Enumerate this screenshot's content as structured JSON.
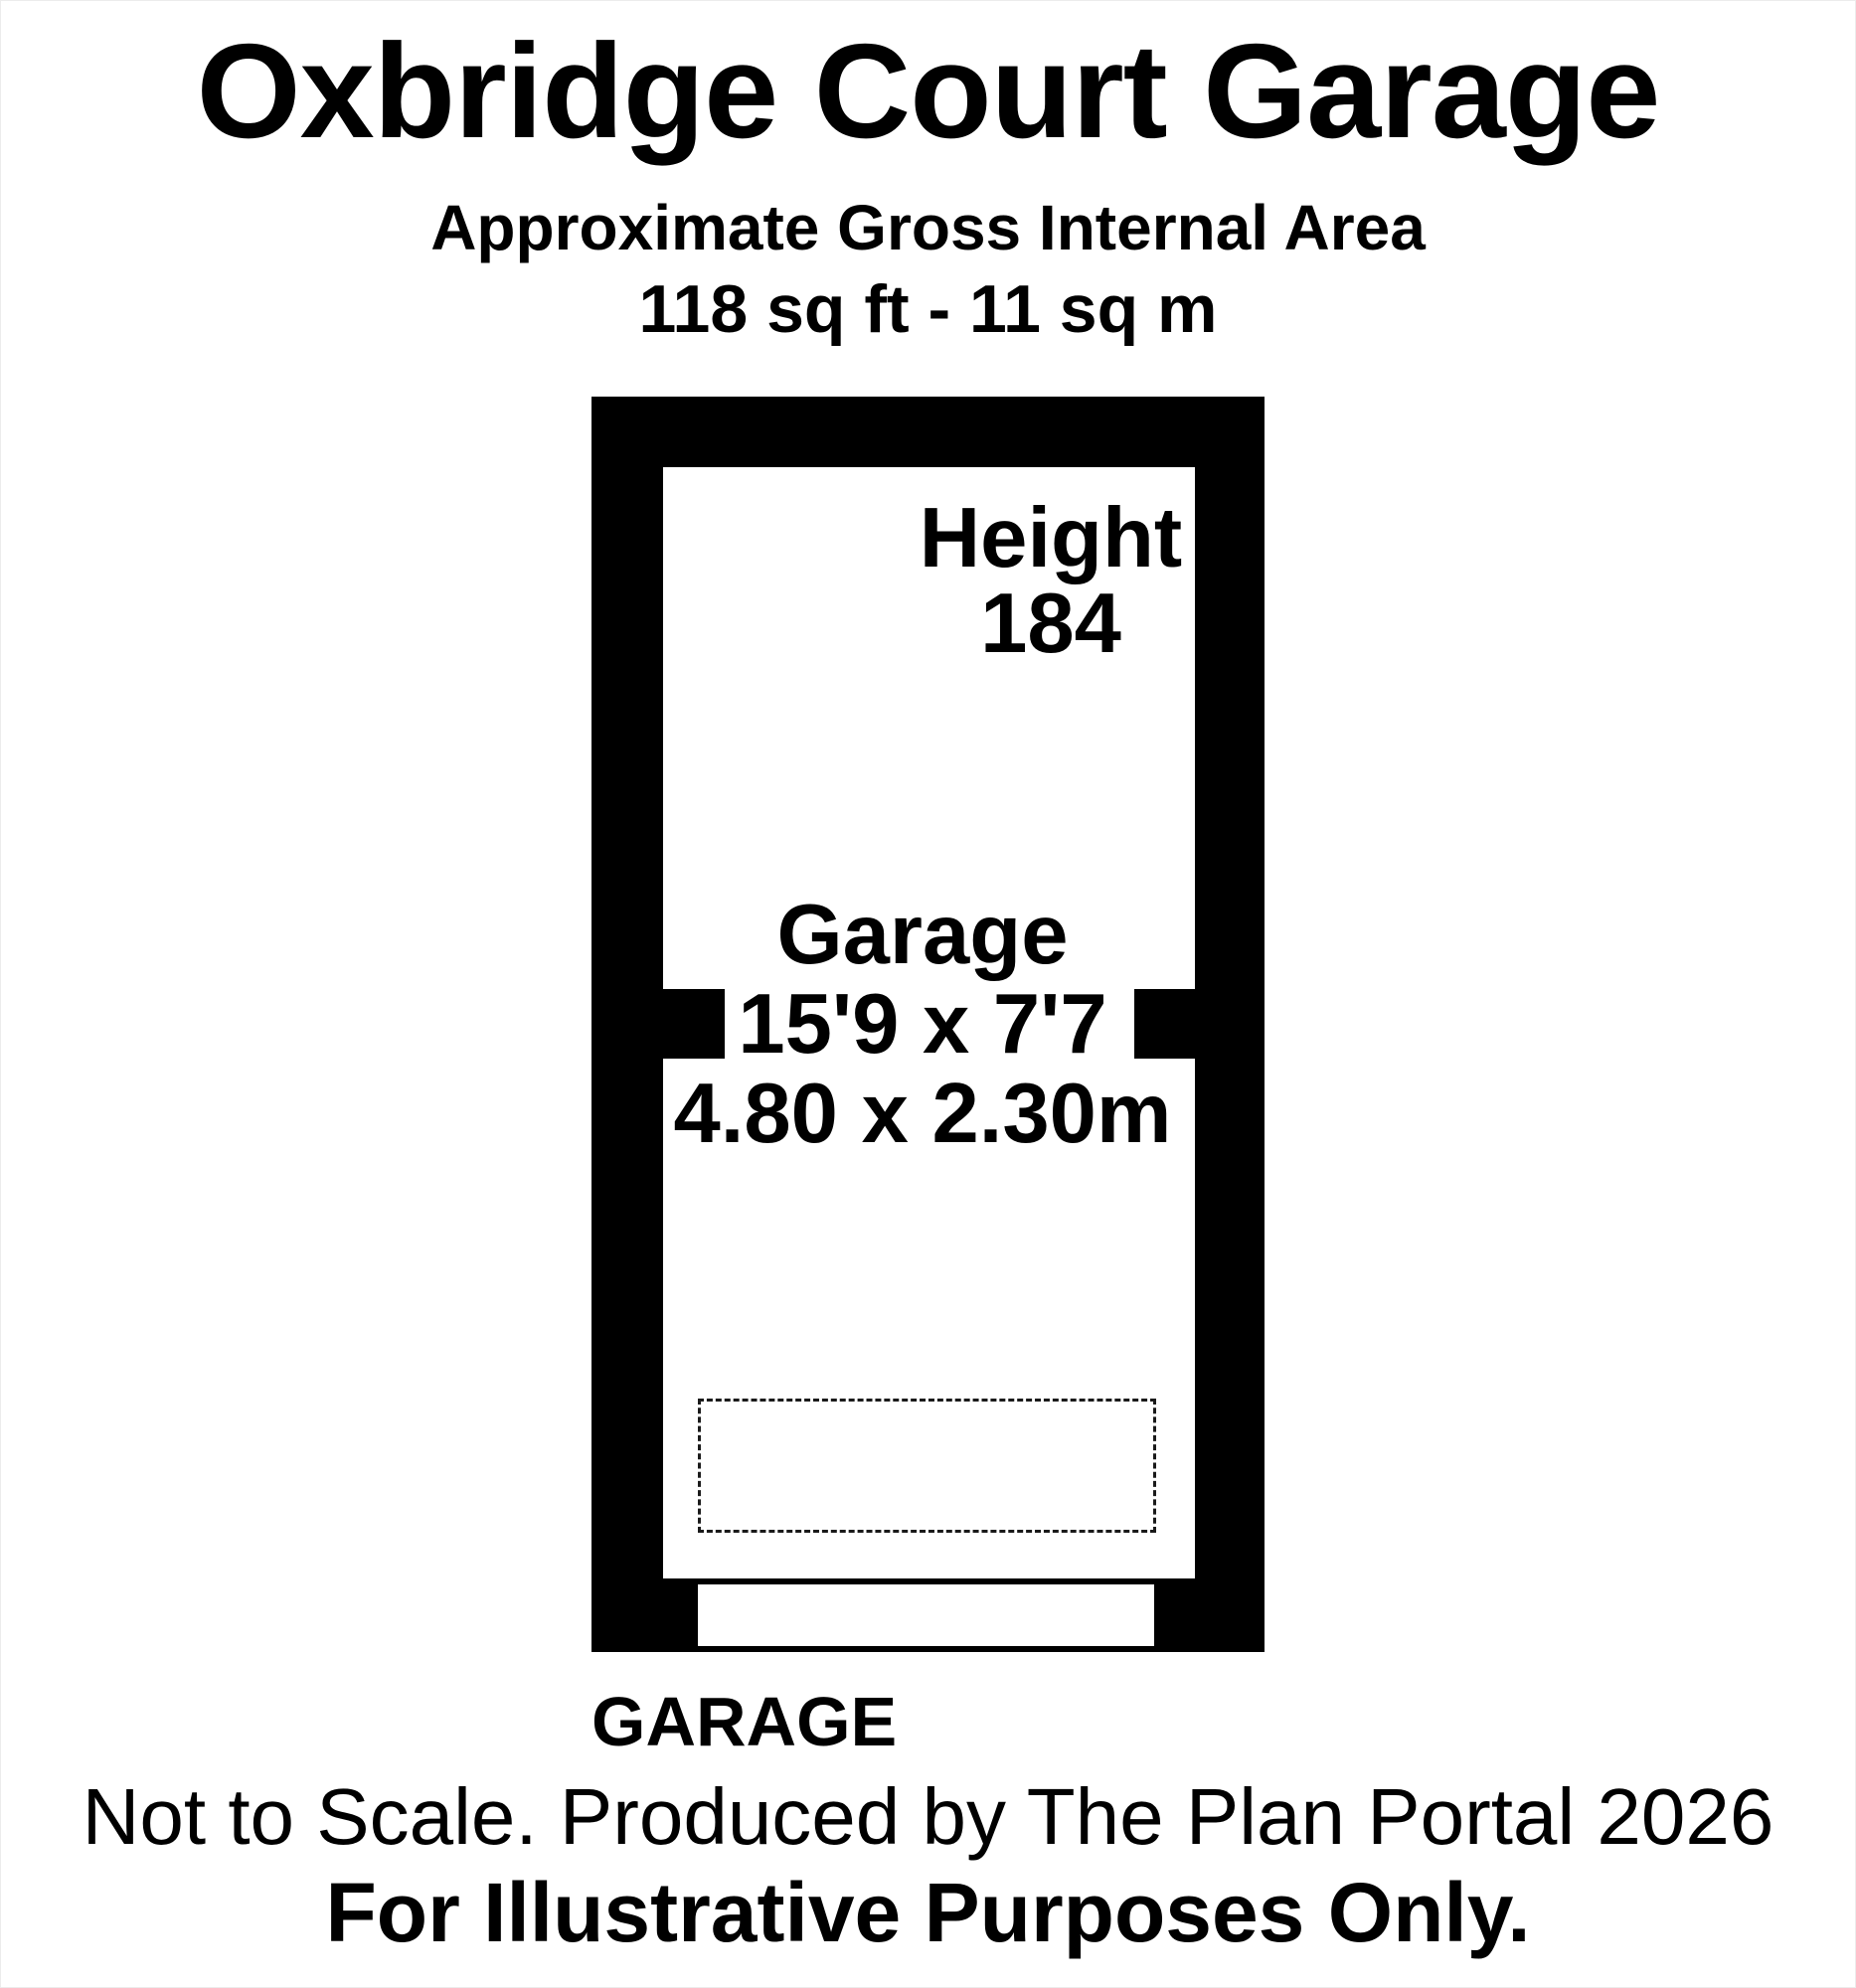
{
  "header": {
    "title": "Oxbridge Court Garage",
    "subtitle": "Approximate Gross Internal Area",
    "area": "118 sq ft - 11 sq m"
  },
  "room": {
    "height_label": "Height",
    "height_value": "184",
    "name": "Garage",
    "dims_imperial": "15'9 x 7'7",
    "dims_metric": "4.80 x 2.30m"
  },
  "footer": {
    "label": "GARAGE",
    "line1": "Not to Scale. Produced by The Plan Portal 2026",
    "line2": "For Illustrative Purposes Only."
  },
  "colors": {
    "wall": "#000000",
    "background": "#ffffff",
    "text": "#000000"
  }
}
